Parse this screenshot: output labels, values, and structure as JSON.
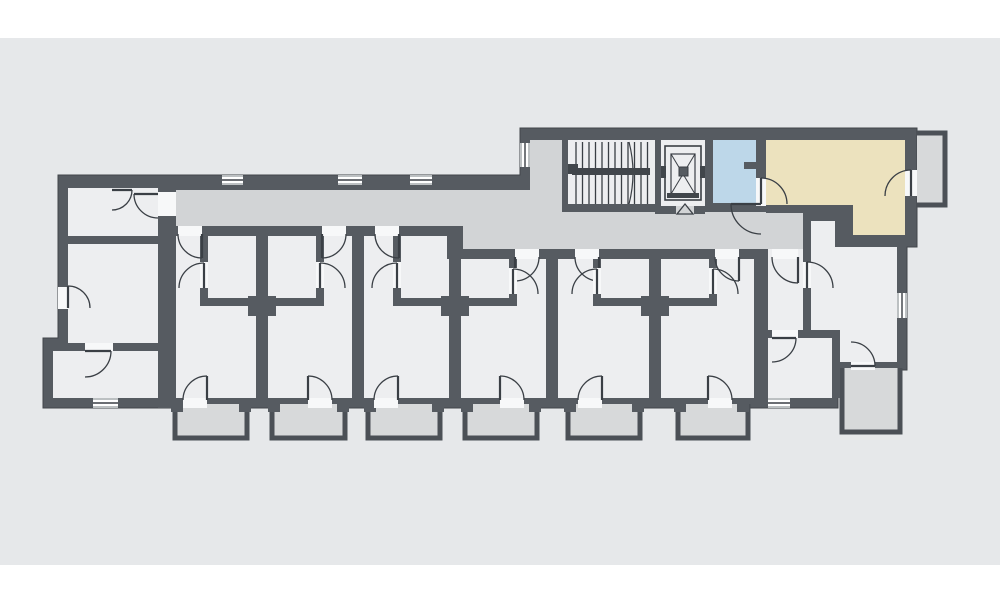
{
  "plan": {
    "colors": {
      "canvas": "#e6e8ea",
      "wall": "#565b61",
      "wall_edge": "#41464b",
      "room": "#edeef0",
      "corridor": "#d2d4d6",
      "balcony": "#d7d9da",
      "balcony_wall": "#4b5056",
      "highlight_blue": "#bdd7e9",
      "highlight_beige": "#ece2be",
      "line": "#3a3f45",
      "gap": "#f7f8f9",
      "white": "#ffffff"
    },
    "canvas_rect": [
      0,
      38,
      1000,
      527
    ],
    "silhouette": [
      [
        58,
        175
      ],
      [
        520,
        175
      ],
      [
        520,
        128
      ],
      [
        917,
        128
      ],
      [
        917,
        247
      ],
      [
        907,
        247
      ],
      [
        907,
        370
      ],
      [
        838,
        370
      ],
      [
        838,
        408
      ],
      [
        43,
        408
      ],
      [
        43,
        338
      ],
      [
        58,
        338
      ]
    ],
    "rooms": [
      {
        "name": "corridor",
        "fill": "corridor",
        "interactable": true,
        "poly": [
          [
            170,
            190
          ],
          [
            530,
            190
          ],
          [
            530,
            212
          ],
          [
            803,
            212
          ],
          [
            803,
            249
          ],
          [
            463,
            249
          ],
          [
            463,
            226
          ],
          [
            170,
            226
          ]
        ]
      },
      {
        "name": "stair-annex",
        "fill": "corridor",
        "interactable": false,
        "rect": [
          530,
          140,
          32,
          72
        ]
      },
      {
        "name": "stairwell",
        "fill": "room",
        "interactable": true,
        "rect": [
          568,
          140,
          87,
          64
        ]
      },
      {
        "name": "elevator-shaft",
        "fill": "room",
        "interactable": true,
        "rect": [
          661,
          140,
          44,
          66
        ]
      },
      {
        "name": "room-highlight-blue",
        "fill": "highlight_blue",
        "interactable": true,
        "rect": [
          713,
          140,
          43,
          63
        ]
      },
      {
        "name": "room-highlight-beige",
        "fill": "highlight_beige",
        "interactable": true,
        "poly": [
          [
            766,
            140
          ],
          [
            905,
            140
          ],
          [
            905,
            235
          ],
          [
            853,
            235
          ],
          [
            853,
            205
          ],
          [
            766,
            205
          ]
        ]
      },
      {
        "name": "left-apartment-entry",
        "fill": "room",
        "interactable": true,
        "rect": [
          68,
          188,
          90,
          48
        ]
      },
      {
        "name": "left-apartment-living",
        "fill": "room",
        "interactable": true,
        "rect": [
          68,
          244,
          90,
          99
        ]
      },
      {
        "name": "left-apartment-bottom-room",
        "fill": "room",
        "interactable": true,
        "rect": [
          53,
          351,
          105,
          47
        ]
      },
      {
        "name": "unit-1-room",
        "fill": "room",
        "interactable": true,
        "rect": [
          176,
          236,
          80,
          162
        ]
      },
      {
        "name": "unit-2-room",
        "fill": "room",
        "interactable": true,
        "rect": [
          268,
          236,
          84,
          162
        ]
      },
      {
        "name": "unit-3-room",
        "fill": "room",
        "interactable": true,
        "rect": [
          364,
          236,
          85,
          162
        ]
      },
      {
        "name": "unit-4-room",
        "fill": "room",
        "interactable": true,
        "rect": [
          461,
          259,
          85,
          139
        ]
      },
      {
        "name": "unit-5-room",
        "fill": "room",
        "interactable": true,
        "rect": [
          558,
          259,
          91,
          139
        ]
      },
      {
        "name": "unit-6-room",
        "fill": "room",
        "interactable": true,
        "rect": [
          661,
          259,
          93,
          139
        ]
      },
      {
        "name": "apartment-hall",
        "fill": "room",
        "interactable": true,
        "rect": [
          768,
          249,
          35,
          81
        ]
      },
      {
        "name": "apartment-living-room",
        "fill": "room",
        "interactable": true,
        "poly": [
          [
            811,
            221
          ],
          [
            835,
            221
          ],
          [
            835,
            247
          ],
          [
            897,
            247
          ],
          [
            897,
            362
          ],
          [
            838,
            362
          ],
          [
            838,
            330
          ],
          [
            811,
            330
          ]
        ]
      },
      {
        "name": "apartment-bottom-room",
        "fill": "room",
        "interactable": true,
        "rect": [
          768,
          338,
          64,
          60
        ]
      }
    ],
    "partitions": [
      [
        158,
        188,
        18,
        220
      ],
      [
        68,
        236,
        90,
        8
      ],
      [
        53,
        343,
        105,
        8
      ],
      [
        165,
        226,
        298,
        10
      ],
      [
        447,
        249,
        321,
        10
      ],
      [
        447,
        226,
        16,
        33
      ],
      [
        200,
        236,
        8,
        26
      ],
      [
        200,
        288,
        8,
        10
      ],
      [
        200,
        298,
        64,
        8
      ],
      [
        248,
        296,
        28,
        20
      ],
      [
        316,
        236,
        8,
        26
      ],
      [
        316,
        288,
        8,
        10
      ],
      [
        256,
        298,
        68,
        8
      ],
      [
        393,
        236,
        8,
        26
      ],
      [
        393,
        288,
        8,
        10
      ],
      [
        393,
        298,
        64,
        8
      ],
      [
        441,
        296,
        28,
        20
      ],
      [
        509,
        259,
        8,
        9
      ],
      [
        509,
        294,
        8,
        12
      ],
      [
        449,
        298,
        68,
        8
      ],
      [
        593,
        259,
        8,
        9
      ],
      [
        593,
        294,
        8,
        12
      ],
      [
        593,
        298,
        64,
        8
      ],
      [
        641,
        296,
        28,
        20
      ],
      [
        709,
        259,
        8,
        9
      ],
      [
        709,
        294,
        8,
        12
      ],
      [
        649,
        298,
        68,
        8
      ],
      [
        754,
        249,
        14,
        149
      ],
      [
        803,
        212,
        8,
        126
      ],
      [
        803,
        213,
        32,
        8
      ],
      [
        766,
        205,
        87,
        8
      ],
      [
        835,
        205,
        18,
        42
      ],
      [
        835,
        235,
        70,
        12
      ],
      [
        760,
        330,
        80,
        8
      ],
      [
        832,
        338,
        8,
        60
      ],
      [
        562,
        140,
        6,
        72
      ],
      [
        655,
        140,
        6,
        74
      ],
      [
        562,
        204,
        99,
        8
      ],
      [
        705,
        140,
        8,
        72
      ],
      [
        661,
        206,
        44,
        8
      ],
      [
        756,
        140,
        10,
        72
      ],
      [
        744,
        162,
        12,
        7
      ],
      [
        705,
        203,
        61,
        9
      ],
      [
        171,
        398,
        12,
        14
      ],
      [
        239,
        398,
        12,
        14
      ],
      [
        268,
        398,
        12,
        14
      ],
      [
        337,
        398,
        12,
        14
      ],
      [
        364,
        398,
        12,
        14
      ],
      [
        432,
        398,
        12,
        14
      ],
      [
        461,
        398,
        12,
        14
      ],
      [
        529,
        398,
        12,
        14
      ],
      [
        564,
        398,
        12,
        14
      ],
      [
        632,
        398,
        12,
        14
      ],
      [
        674,
        398,
        12,
        14
      ],
      [
        737,
        398,
        12,
        14
      ]
    ],
    "balconies": [
      {
        "name": "balcony-1",
        "rect": [
          175,
          404,
          72,
          34
        ],
        "open": "top"
      },
      {
        "name": "balcony-2",
        "rect": [
          272,
          404,
          73,
          34
        ],
        "open": "top"
      },
      {
        "name": "balcony-3",
        "rect": [
          368,
          404,
          72,
          34
        ],
        "open": "top"
      },
      {
        "name": "balcony-4",
        "rect": [
          465,
          404,
          72,
          34
        ],
        "open": "top"
      },
      {
        "name": "balcony-5",
        "rect": [
          568,
          404,
          72,
          34
        ],
        "open": "top"
      },
      {
        "name": "balcony-6",
        "rect": [
          678,
          404,
          70,
          34
        ],
        "open": "top"
      },
      {
        "name": "balcony-bottom-right",
        "rect": [
          842,
          368,
          58,
          64
        ],
        "open": "top"
      },
      {
        "name": "balcony-top-right",
        "rect": [
          917,
          133,
          28,
          72
        ],
        "open": "left"
      }
    ],
    "windows": [
      {
        "name": "window-corridor-1",
        "rect": [
          222,
          175,
          21,
          10
        ]
      },
      {
        "name": "window-corridor-2",
        "rect": [
          338,
          175,
          24,
          10
        ]
      },
      {
        "name": "window-corridor-3",
        "rect": [
          410,
          175,
          22,
          10
        ]
      },
      {
        "name": "window-stair-annex",
        "rect": [
          520,
          143,
          10,
          24
        ]
      },
      {
        "name": "window-right-wall",
        "rect": [
          897,
          293,
          10,
          25
        ]
      },
      {
        "name": "window-left-bottom",
        "rect": [
          93,
          398,
          25,
          10
        ]
      },
      {
        "name": "window-apartment-bottom",
        "rect": [
          768,
          398,
          22,
          10
        ]
      }
    ],
    "doors": [
      {
        "name": "door-left-entry-room",
        "gap": [
          158,
          192,
          18,
          24
        ],
        "hinge": [
          158,
          194
        ],
        "r": 24,
        "a0": 180,
        "a1": 90
      },
      {
        "name": "door-left-entry-inner",
        "gap": null,
        "hinge": [
          112,
          190
        ],
        "r": 20,
        "a0": 0,
        "a1": 90
      },
      {
        "name": "door-left-exterior",
        "gap": [
          58,
          287,
          10,
          22
        ],
        "hinge": [
          68,
          308
        ],
        "r": 22,
        "a0": 270,
        "a1": 0
      },
      {
        "name": "door-left-bottom-room",
        "gap": [
          85,
          343,
          28,
          8
        ],
        "hinge": [
          85,
          351
        ],
        "r": 26,
        "a0": 0,
        "a1": 90
      },
      {
        "name": "door-unit-1-entry",
        "gap": [
          178,
          226,
          24,
          10
        ],
        "hinge": [
          202,
          234
        ],
        "r": 24,
        "a0": 90,
        "a1": 180
      },
      {
        "name": "door-unit-1-bath",
        "gap": [
          200,
          262,
          8,
          26
        ],
        "hinge": [
          204,
          288
        ],
        "r": 25,
        "a0": 270,
        "a1": 180
      },
      {
        "name": "door-unit-1-balcony",
        "gap": [
          183,
          398,
          24,
          10
        ],
        "hinge": [
          207,
          400
        ],
        "r": 24,
        "a0": 270,
        "a1": 180
      },
      {
        "name": "door-unit-2-entry",
        "gap": [
          322,
          226,
          24,
          10
        ],
        "hinge": [
          322,
          234
        ],
        "r": 24,
        "a0": 90,
        "a1": 0
      },
      {
        "name": "door-unit-2-bath",
        "gap": [
          316,
          262,
          8,
          26
        ],
        "hinge": [
          320,
          288
        ],
        "r": 25,
        "a0": 270,
        "a1": 0
      },
      {
        "name": "door-unit-2-balcony",
        "gap": [
          308,
          398,
          24,
          10
        ],
        "hinge": [
          308,
          400
        ],
        "r": 24,
        "a0": 270,
        "a1": 0
      },
      {
        "name": "door-unit-3-entry",
        "gap": [
          375,
          226,
          24,
          10
        ],
        "hinge": [
          399,
          234
        ],
        "r": 24,
        "a0": 90,
        "a1": 180
      },
      {
        "name": "door-unit-3-bath",
        "gap": [
          393,
          262,
          8,
          26
        ],
        "hinge": [
          397,
          288
        ],
        "r": 25,
        "a0": 270,
        "a1": 180
      },
      {
        "name": "door-unit-3-balcony",
        "gap": [
          374,
          398,
          24,
          10
        ],
        "hinge": [
          398,
          400
        ],
        "r": 24,
        "a0": 270,
        "a1": 180
      },
      {
        "name": "door-unit-4-entry",
        "gap": [
          515,
          249,
          24,
          10
        ],
        "hinge": [
          515,
          257
        ],
        "r": 24,
        "a0": 90,
        "a1": 0
      },
      {
        "name": "door-unit-4-bath",
        "gap": [
          509,
          268,
          8,
          26
        ],
        "hinge": [
          513,
          294
        ],
        "r": 25,
        "a0": 270,
        "a1": 0
      },
      {
        "name": "door-unit-4-balcony",
        "gap": [
          500,
          398,
          24,
          10
        ],
        "hinge": [
          500,
          400
        ],
        "r": 24,
        "a0": 270,
        "a1": 0
      },
      {
        "name": "door-unit-5-entry",
        "gap": [
          575,
          249,
          24,
          10
        ],
        "hinge": [
          599,
          257
        ],
        "r": 24,
        "a0": 90,
        "a1": 180
      },
      {
        "name": "door-unit-5-bath",
        "gap": [
          593,
          268,
          8,
          26
        ],
        "hinge": [
          597,
          294
        ],
        "r": 25,
        "a0": 270,
        "a1": 180
      },
      {
        "name": "door-unit-5-balcony",
        "gap": [
          578,
          398,
          24,
          10
        ],
        "hinge": [
          602,
          400
        ],
        "r": 24,
        "a0": 270,
        "a1": 180
      },
      {
        "name": "door-unit-6-entry",
        "gap": [
          715,
          249,
          24,
          10
        ],
        "hinge": [
          739,
          257
        ],
        "r": 24,
        "a0": 90,
        "a1": 180
      },
      {
        "name": "door-unit-6-bath",
        "gap": [
          709,
          268,
          8,
          26
        ],
        "hinge": [
          713,
          294
        ],
        "r": 25,
        "a0": 270,
        "a1": 0
      },
      {
        "name": "door-unit-6-balcony",
        "gap": [
          708,
          398,
          24,
          10
        ],
        "hinge": [
          708,
          400
        ],
        "r": 24,
        "a0": 270,
        "a1": 0
      },
      {
        "name": "door-beige-room",
        "gap": [
          756,
          178,
          10,
          28
        ],
        "hinge": [
          761,
          204
        ],
        "r": 26,
        "a0": 270,
        "a1": 0
      },
      {
        "name": "door-beige-room-second-leaf",
        "gap": null,
        "hinge": [
          761,
          204
        ],
        "r": 30,
        "a0": 180,
        "a1": 90
      },
      {
        "name": "door-beige-balcony",
        "gap": [
          905,
          170,
          12,
          26
        ],
        "hinge": [
          911,
          196
        ],
        "r": 26,
        "a0": 270,
        "a1": 180
      },
      {
        "name": "door-apartment-hall",
        "gap": [
          772,
          249,
          26,
          10
        ],
        "hinge": [
          798,
          257
        ],
        "r": 26,
        "a0": 90,
        "a1": 180
      },
      {
        "name": "door-hall-living",
        "gap": [
          803,
          262,
          8,
          26
        ],
        "hinge": [
          807,
          288
        ],
        "r": 26,
        "a0": 270,
        "a1": 0
      },
      {
        "name": "door-hall-bottom-room",
        "gap": [
          772,
          330,
          26,
          8
        ],
        "hinge": [
          772,
          338
        ],
        "r": 24,
        "a0": 0,
        "a1": 90
      },
      {
        "name": "door-living-balcony",
        "gap": [
          851,
          362,
          24,
          8
        ],
        "hinge": [
          851,
          366
        ],
        "r": 24,
        "a0": 0,
        "a1": 270
      }
    ],
    "extra_gaps": [
      [
        676,
        206,
        18,
        8
      ]
    ],
    "stairs": {
      "tread_x0": 576,
      "tread_count": 12,
      "tread_step": 6.5,
      "y0": 142,
      "y1": 204,
      "rail": [
        572,
        168,
        78,
        7
      ],
      "newel": [
        568,
        164,
        10,
        10
      ],
      "break_line": "M629,142 Q637,173 629,204"
    },
    "elevator": {
      "outer": [
        665,
        146,
        36,
        54
      ],
      "car": [
        671,
        154,
        24,
        40
      ],
      "center_box": [
        679,
        167,
        9,
        9
      ],
      "stub_left": [
        661,
        166,
        5,
        12
      ],
      "stub_right": [
        700,
        166,
        5,
        12
      ],
      "door_bar": [
        667,
        193,
        32,
        5
      ],
      "direction_marker": [
        [
          677,
          214
        ],
        [
          693,
          214
        ],
        [
          685,
          204
        ]
      ]
    }
  }
}
